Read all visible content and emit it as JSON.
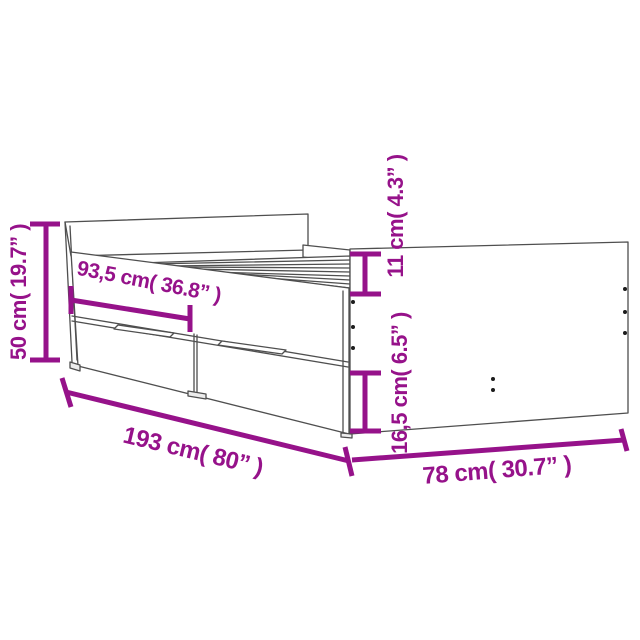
{
  "diagram": {
    "kind": "furniture-dimension-diagram",
    "subject": "bed frame with drawers, side and end view line drawing",
    "accent_color": "#96128A",
    "line_color": "#4f4f4f",
    "labels": {
      "height": "50 cm( 19.7” )",
      "drawer_width": "93,5 cm( 36.8” )",
      "rail_height": "11 cm( 4.3” )",
      "drawer_height": "16,5 cm( 6.5” )",
      "length": "193 cm( 80” )",
      "width": "78 cm( 30.7” )"
    }
  }
}
